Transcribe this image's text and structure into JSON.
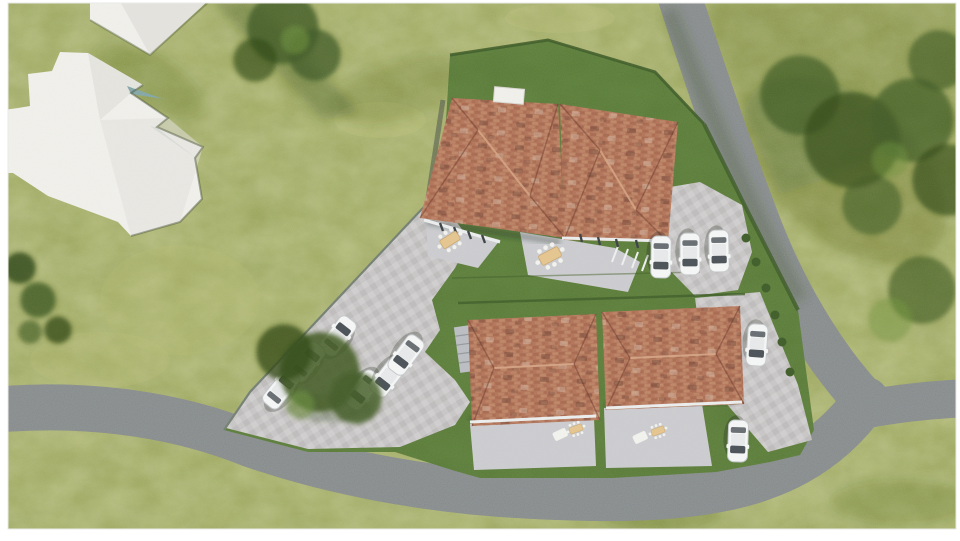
{
  "scene": {
    "kind": "aerial-3d-architectural-site-render",
    "colors": {
      "frame": "#ffffff",
      "meadow": "#a7b06a",
      "lawn": "#5d7c40",
      "hedge": "#3f5a2c",
      "road": "#84888e",
      "pavement": "#c8c5c8",
      "patio": "#ccccd2",
      "roof_tile": "#b0705a",
      "roof_tile_dark": "#9d5c4b",
      "roof_tile_light": "#c98f74",
      "building_white": "#f3f2ef",
      "building_shade": "#e3e2de",
      "car_body": "#f8f9fa",
      "car_glass": "#4a5058",
      "tree": "#42592a",
      "tree_dark": "#33491d",
      "tree_light": "#6d8f3f",
      "table": "#e7c48e",
      "chair": "#f5f5f2",
      "shadow": "#2e4418"
    },
    "counts": {
      "red_roof_houses": 4,
      "white_neighbor_buildings": 2,
      "cars": 11,
      "patio_dining_sets": 2,
      "small_patio_sets": 2,
      "roads": 3,
      "tree_clusters": 5
    },
    "elements": [
      "white neighbor building massing (top-left)",
      "upper duplex with two red tile hip roofs, patios and dining tables",
      "two lower detached houses with red tile hip roofs",
      "paved parking court with six angled white cars",
      "row of three white cars beside upper duplex",
      "two white cars on east driveway",
      "asphalt access roads around the plot",
      "dark green fenced lawns with hedges",
      "meadow grass and tree clusters"
    ]
  }
}
